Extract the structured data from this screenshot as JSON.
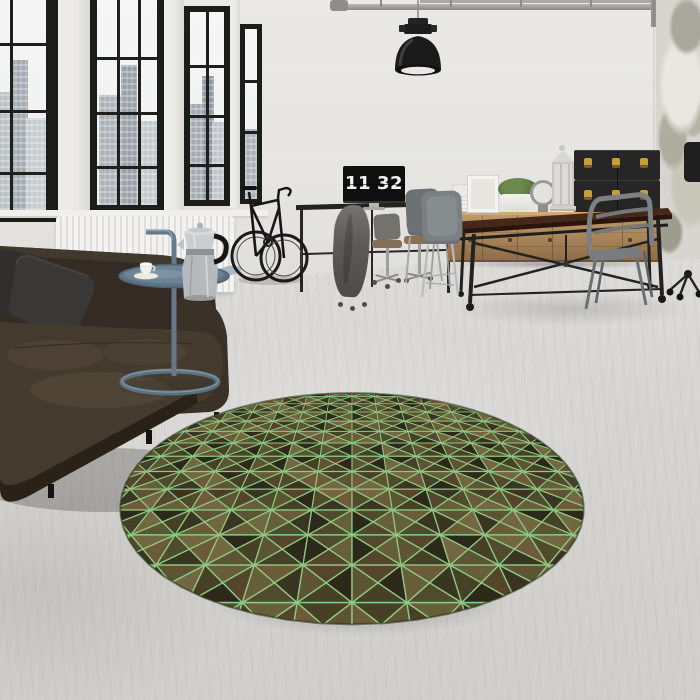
{
  "scene": {
    "title": "Industrial loft interior with round olive-green geometric rug",
    "monitor_clock": {
      "hours": "11",
      "minutes": "32",
      "digit_color": "#f2f2f1",
      "screen_color": "#0f0f0f"
    },
    "rug": {
      "type": "round-rug",
      "center_x": 352,
      "top_y": 393,
      "bottom_y": 625,
      "radius_px": 207,
      "perspective_z0": 2.2,
      "cells_across": 13,
      "grid_color": "#8fc883",
      "palette": [
        "#2c291a",
        "#3a3522",
        "#454026",
        "#514b2d",
        "#5c5433",
        "#675e3a",
        "#726741",
        "#55452c",
        "#6d5a39"
      ],
      "edge_color": "#243018",
      "shadow_color": "rgba(75,73,65,0.40)"
    },
    "colors": {
      "wall": "#e6e5e2",
      "floor_light": "#dcdbd8",
      "floor_dark": "#cfceca",
      "window_frame": "#1c1c1b",
      "glass": "#f3f4f3",
      "sofa": "#3a3129",
      "pillow": "#343230",
      "side_table": "#6d8191",
      "radiator": "#f1f0ed",
      "wood": "#aa865c",
      "table_top": "#46281a",
      "iron": "#232120",
      "chair_metal": "#7d8184",
      "trunk": "#262626",
      "trunk_latch": "#c79d3e",
      "lamp": "#1b1b1b",
      "plant": "#5b7a40"
    },
    "objects": [
      {
        "name": "industrial-windows"
      },
      {
        "name": "city-skyline"
      },
      {
        "name": "radiator"
      },
      {
        "name": "leather-sofa"
      },
      {
        "name": "cushions"
      },
      {
        "name": "side-table"
      },
      {
        "name": "moka-pot"
      },
      {
        "name": "coffee-cup"
      },
      {
        "name": "road-bike"
      },
      {
        "name": "desk"
      },
      {
        "name": "flip-clock-monitor"
      },
      {
        "name": "office-chairs"
      },
      {
        "name": "hanging-hoodie"
      },
      {
        "name": "pendant-lamp"
      },
      {
        "name": "ceiling-pipes"
      },
      {
        "name": "wooden-sideboard"
      },
      {
        "name": "storage-trunks"
      },
      {
        "name": "potted-plant"
      },
      {
        "name": "lantern"
      },
      {
        "name": "gadget-clock"
      },
      {
        "name": "dining-table"
      },
      {
        "name": "metal-chairs"
      },
      {
        "name": "distressed-wall"
      },
      {
        "name": "round-geometric-rug"
      }
    ]
  }
}
